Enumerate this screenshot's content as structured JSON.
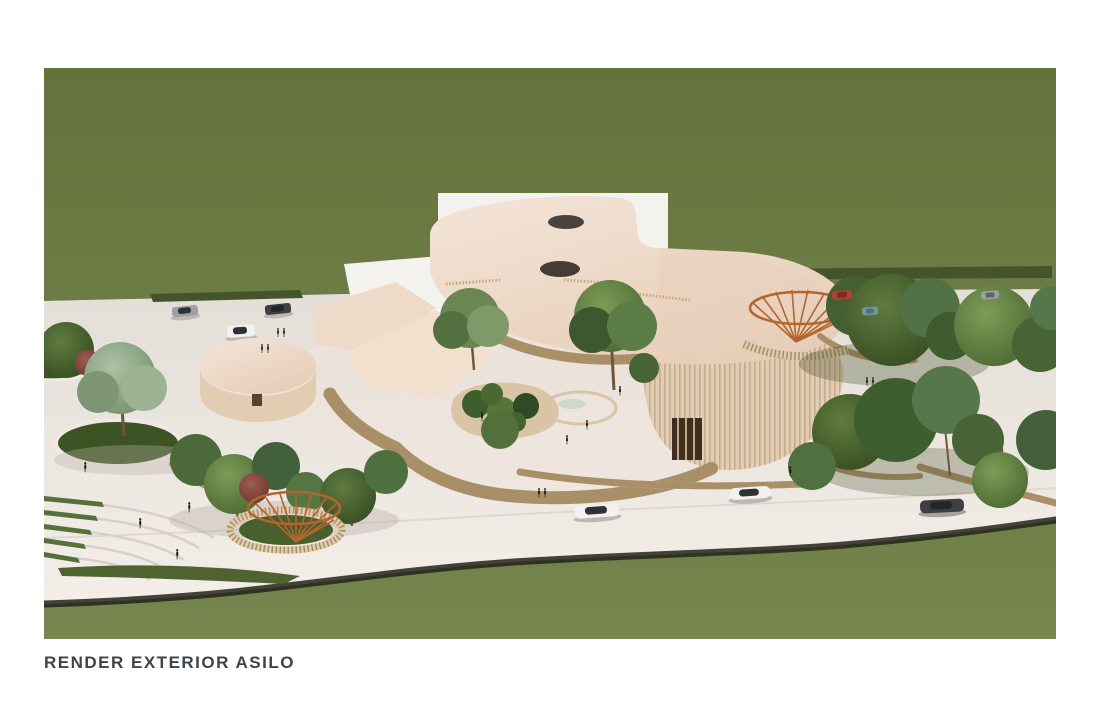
{
  "page": {
    "background_color": "#ffffff"
  },
  "figure": {
    "caption": "RENDER EXTERIOR ASILO",
    "alt": "Aerial exterior 3D render of a kindergarten (asilo): an organic cream-roofed building with two oval skylights, circular wings, vertical timber-slat fences, a central courtyard with a round pond and planting beds, tree islands, amphitheatre lawn steps, two copper fan-shaped canopy pavilions, parking areas with cars, an access road with driving cars and small pedestrian figures, all set on a wide light-stone plaza crossing a green lawn.",
    "scene": {
      "setting": "green lawn site crossed diagonally by a light paved plaza",
      "building": "curved cream roof with two dark oval skylights, white flat back roof, circular rotunda wing, louvered timber facades",
      "landscape_features": [
        "central courtyard with round pond",
        "kidney-shaped planting bed",
        "circular grass tree islands",
        "amphitheatre steps with grass treads",
        "copper radial canopy pavilion (left)",
        "copper radial canopy pavilion (right)",
        "curved timber slat fences",
        "hedge rows along plaza edge"
      ],
      "vehicles": [
        "white cars on road",
        "dark car on road",
        "parked gray car",
        "parked dark car",
        "parked white car",
        "parked red car",
        "parked teal car"
      ],
      "people": "small dark pedestrian silhouettes scattered on the plaza and courtyard"
    }
  },
  "palette": {
    "page": "#ffffff",
    "caption_text": "#3e434b",
    "grass": "#6e7d45",
    "platform": "#e8e2dd",
    "plaza_shadow": "#23241a",
    "hedge": "#44552c",
    "lawn": "#3c5323",
    "roof_cream": "#eedac9",
    "roof_white": "#f3f2ef",
    "wall_beige": "#e3cdb2",
    "louver_brown": "#6e4e33",
    "slat_light": "#e0cbaa",
    "slat_dark": "#a98f68",
    "pond": "#8db0a7",
    "pond_rim": "#d8c4a6",
    "canopy_copper": "#b2652e",
    "tree_dark": "#35491f",
    "tree_mid": "#4a662f",
    "tree_sage": "#73906b",
    "tree_red": "#6d3530",
    "trunk": "#6f563b",
    "people": "#1b1b1d",
    "car_white": "#f2f1ee",
    "car_gray": "#9aa0a3",
    "car_dark": "#3c4043",
    "car_red": "#b04038",
    "car_teal": "#6f9aa3",
    "step_line": "#d8d0c7"
  }
}
